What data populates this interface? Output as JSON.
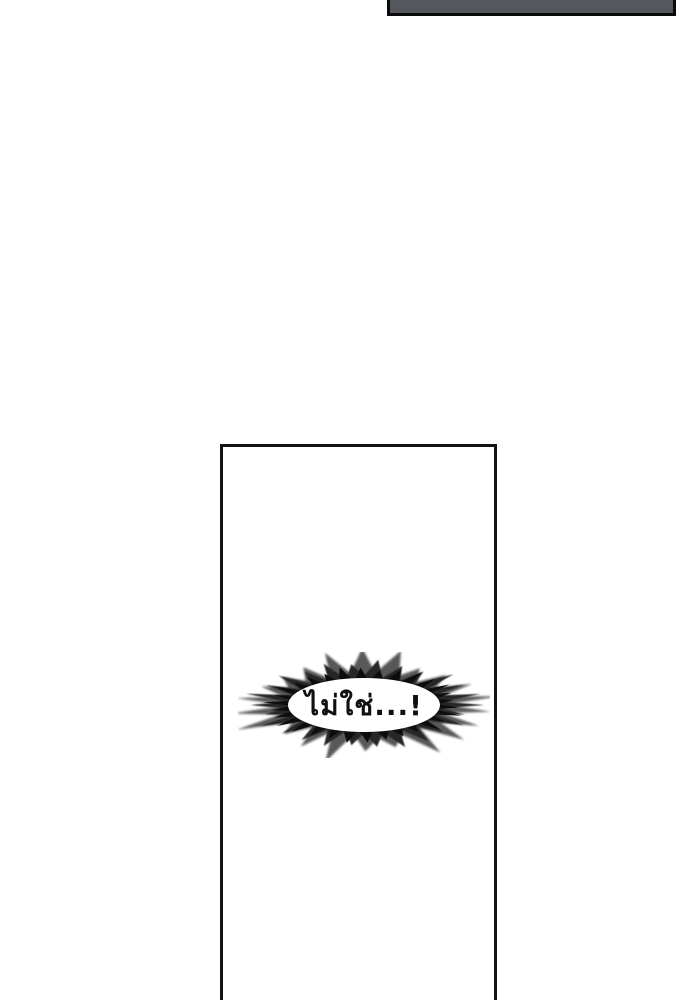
{
  "page": {
    "background_color": "#ffffff"
  },
  "previous_panel_fragment": {
    "fill_color": "#54585d",
    "border_color": "#0b0b0b"
  },
  "panel": {
    "background_color": "#ffffff",
    "border_color": "#141414"
  },
  "speech_burst": {
    "text": "ไม่ใช่...!",
    "text_color": "#111111",
    "spike_color_back": "#585858",
    "spike_color_mid": "#262626",
    "spike_color_front": "#0d0d0d",
    "center_fill": "#ffffff"
  }
}
